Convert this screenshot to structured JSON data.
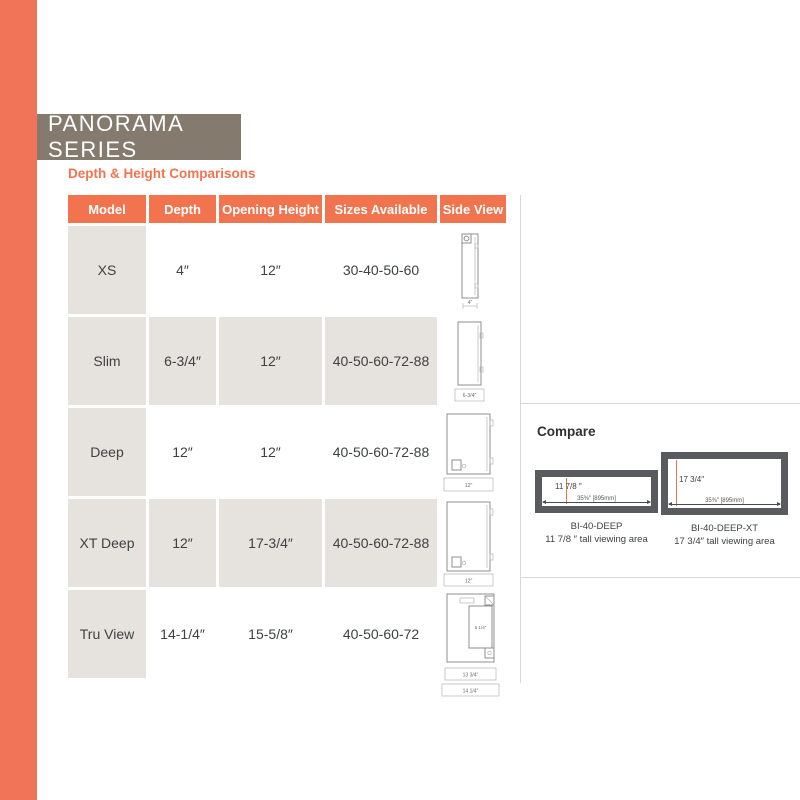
{
  "page": {
    "title": "PANORAMA SERIES",
    "subtitle": "Depth & Height Comparisons"
  },
  "colors": {
    "accent_orange": "#f1744f",
    "title_brown": "#857a6e",
    "cell_beige": "#e6e2dd",
    "frame_gray": "#595b5e"
  },
  "table": {
    "headers": [
      "Model",
      "Depth",
      "Opening Height",
      "Sizes Available",
      "Side View"
    ],
    "rows": [
      {
        "model": "XS",
        "depth": "4″",
        "opening_height": "12″",
        "sizes": "30-40-50-60",
        "side_dim": "4″"
      },
      {
        "model": "Slim",
        "depth": "6-3/4″",
        "opening_height": "12″",
        "sizes": "40-50-60-72-88",
        "side_dim": "6-3/4″"
      },
      {
        "model": "Deep",
        "depth": "12″",
        "opening_height": "12″",
        "sizes": "40-50-60-72-88",
        "side_dim": "12″"
      },
      {
        "model": "XT Deep",
        "depth": "12″",
        "opening_height": "17-3/4″",
        "sizes": "40-50-60-72-88",
        "side_dim": "12″"
      },
      {
        "model": "Tru View",
        "depth": "14-1/4″",
        "opening_height": "15-5/8″",
        "sizes": "40-50-60-72",
        "side_dim_inner": "5 1/4″",
        "side_dim_1": "13 3/4″",
        "side_dim_2": "14 1/4″"
      }
    ]
  },
  "compare": {
    "heading": "Compare",
    "units": [
      {
        "height_label": "11 7/8 ″",
        "width_label": "35⅜″ [895mm]",
        "model": "BI-40-DEEP",
        "caption": "11 7/8 ″ tall viewing area"
      },
      {
        "height_label": "17 3/4″",
        "width_label": "35⅜″ [895mm]",
        "model": "BI-40-DEEP-XT",
        "caption": "17 3/4″ tall viewing area"
      }
    ]
  }
}
